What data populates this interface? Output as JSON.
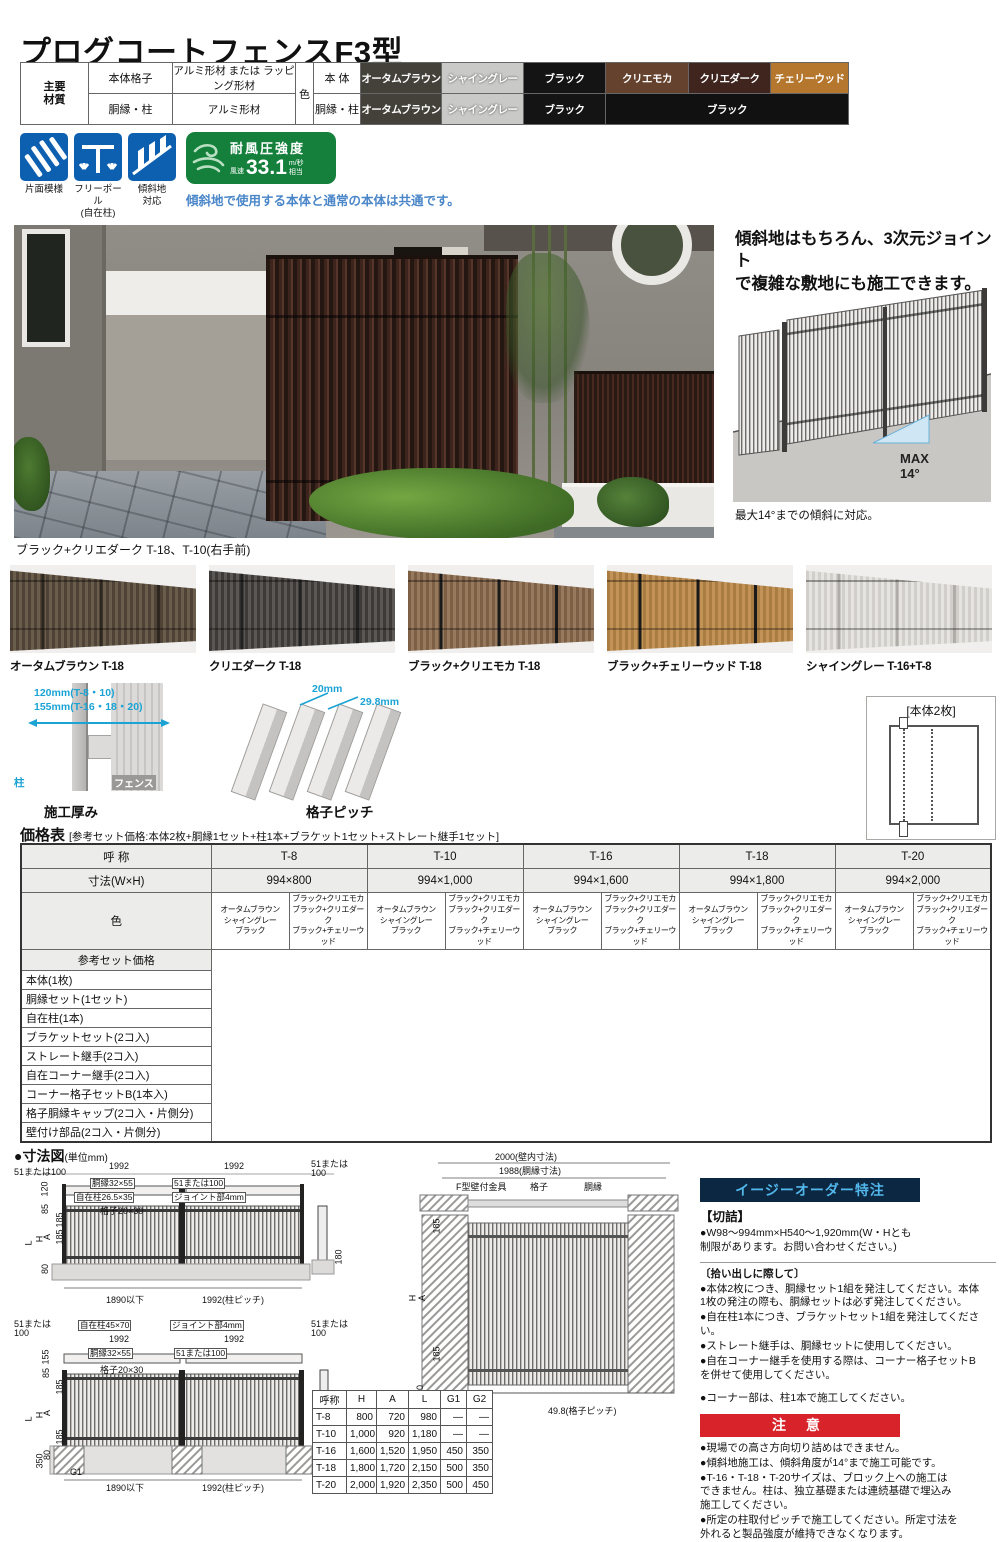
{
  "title": "プログコートフェンスF3型",
  "materials": {
    "header": "主要\n材質",
    "rows": [
      {
        "part": "本体格子",
        "value": "アルミ形材 または ラッピング形材"
      },
      {
        "part": "胴縁・柱",
        "value": "アルミ形材"
      }
    ],
    "color_label": "色",
    "body_row_label": "本 体",
    "frame_row_label": "胴縁・柱",
    "body_chips": [
      {
        "label": "オータムブラウン",
        "bg": "#44403a",
        "fg": "#ffffff"
      },
      {
        "label": "シャイングレー",
        "bg": "#c9c9c7",
        "fg": "#ffffff",
        "c": "sh"
      },
      {
        "label": "ブラック",
        "bg": "#141414",
        "fg": "#ffffff"
      },
      {
        "label": "クリエモカ",
        "bg": "#64422e",
        "fg": "#ffffff"
      },
      {
        "label": "クリエダーク",
        "bg": "#40251f",
        "fg": "#ffffff"
      },
      {
        "label": "チェリーウッド",
        "bg": "#b5772e",
        "fg": "#ffffff"
      }
    ],
    "frame_chips": [
      {
        "label": "オータムブラウン",
        "bg": "#44403a",
        "fg": "#ffffff",
        "span": 1
      },
      {
        "label": "シャイングレー",
        "bg": "#c9c9c7",
        "fg": "#ffffff",
        "span": 1,
        "c": "sh"
      },
      {
        "label": "ブラック",
        "bg": "#141414",
        "fg": "#ffffff",
        "span": 1
      },
      {
        "label": "ブラック",
        "bg": "#111111",
        "fg": "#ffffff",
        "span": 3
      }
    ]
  },
  "features": {
    "icons": [
      {
        "label": "片面模様"
      },
      {
        "label": "フリーポール\n(自在柱)"
      },
      {
        "label": "傾斜地\n対応"
      }
    ],
    "wind": {
      "title": "耐風圧強度",
      "speed_label": "風速",
      "value": "33.1",
      "unit": "m/秒",
      "suffix": "相当"
    },
    "note": "傾斜地で使用する本体と通常の本体は共通です。",
    "icon_color": "#0d5fb0",
    "badge_color": "#14803c"
  },
  "photo": {
    "caption": "ブラック+クリエダーク T-18、T-10(右手前)"
  },
  "slope": {
    "heading": "傾斜地はもちろん、3次元ジョイント\nで複雑な敷地にも施工できます。",
    "max_label": "MAX\n14°",
    "caption": "最大14°までの傾斜に対応。"
  },
  "variations": [
    {
      "label": "オータムブラウン T-18",
      "slat": "#4e4336",
      "lite": "#6b5d4b",
      "post": "#2e271f"
    },
    {
      "label": "クリエダーク T-18",
      "slat": "#3e3a38",
      "lite": "#5b5754",
      "post": "#222222"
    },
    {
      "label": "ブラック+クリエモカ T-18",
      "slat": "#7c5f45",
      "lite": "#97795e",
      "post": "#1a1a1a"
    },
    {
      "label": "ブラック+チェリーウッド T-18",
      "slat": "#a97c42",
      "lite": "#c29257",
      "post": "#1a1a1a"
    },
    {
      "label": "シャイングレー T-16+T-8",
      "slat": "#d2cfca",
      "lite": "#e6e4e0",
      "post": "#b0ada8"
    }
  ],
  "spec": {
    "thickness": {
      "dim1": "120mm(T-8・10)",
      "dim2": "155mm(T-16・18・20)",
      "post_label": "柱",
      "fence_label": "フェンス",
      "caption": "施工厚み"
    },
    "pitch": {
      "dim1": "20mm",
      "dim2": "29.8mm",
      "caption": "格子ピッチ"
    },
    "panel_note": "[本体2枚]"
  },
  "price": {
    "title": "価格表",
    "subtitle": "[参考セット価格:本体2枚+胴縁1セット+柱1本+ブラケット1セット+ストレート継手1セット]",
    "name_header": "呼 称",
    "size_header": "寸法(W×H)",
    "color_header": "色",
    "set_header": "参考セット価格",
    "columns": [
      {
        "name": "T-8",
        "size": "994×800",
        "colors_a": "オータムブラウン\nシャイングレー\nブラック",
        "colors_b": "ブラック+クリエモカ\nブラック+クリエダーク\nブラック+チェリーウッド"
      },
      {
        "name": "T-10",
        "size": "994×1,000",
        "colors_a": "オータムブラウン\nシャイングレー\nブラック",
        "colors_b": "ブラック+クリエモカ\nブラック+クリエダーク\nブラック+チェリーウッド"
      },
      {
        "name": "T-16",
        "size": "994×1,600",
        "colors_a": "オータムブラウン\nシャイングレー\nブラック",
        "colors_b": "ブラック+クリエモカ\nブラック+クリエダーク\nブラック+チェリーウッド"
      },
      {
        "name": "T-18",
        "size": "994×1,800",
        "colors_a": "オータムブラウン\nシャイングレー\nブラック",
        "colors_b": "ブラック+クリエモカ\nブラック+クリエダーク\nブラック+チェリーウッド"
      },
      {
        "name": "T-20",
        "size": "994×2,000",
        "colors_a": "オータムブラウン\nシャイングレー\nブラック",
        "colors_b": "ブラック+クリエモカ\nブラック+クリエダーク\nブラック+チェリーウッド"
      }
    ],
    "items": [
      "本体(1枚)",
      "胴縁セット(1セット)",
      "自在柱(1本)",
      "ブラケットセット(2コ入)",
      "ストレート継手(2コ入)",
      "自在コーナー継手(2コ入)",
      "コーナー格子セットB(1本入)",
      "格子胴縁キャップ(2コ入・片側分)",
      "壁付け部品(2コ入・片側分)"
    ]
  },
  "dims": {
    "section_title": "●寸法図",
    "unit": "(単位mm)",
    "diagram_a_labels": [
      {
        "t": "51または100",
        "x": 0,
        "y": 8
      },
      {
        "t": "1992",
        "x": 95,
        "y": 2
      },
      {
        "t": "1992",
        "x": 210,
        "y": 2
      },
      {
        "t": "51または",
        "x": 297,
        "y": 0
      },
      {
        "t": "100",
        "x": 297,
        "y": 9
      },
      {
        "t": "胴縁32×55",
        "x": 76,
        "y": 18,
        "c": "bx"
      },
      {
        "t": "51または100",
        "x": 158,
        "y": 18,
        "c": "bx"
      },
      {
        "t": "自在柱26.5×35",
        "x": 60,
        "y": 32,
        "c": "bx"
      },
      {
        "t": "ジョイント部4mm",
        "x": 158,
        "y": 32,
        "c": "bx"
      },
      {
        "t": "格子20×30",
        "x": 86,
        "y": 47
      },
      {
        "t": "120",
        "x": 24,
        "y": 24,
        "c": "v"
      },
      {
        "t": "85",
        "x": 27,
        "y": 44,
        "c": "v"
      },
      {
        "t": "185",
        "x": 39,
        "y": 55,
        "c": "v"
      },
      {
        "t": "185",
        "x": 39,
        "y": 72,
        "c": "v"
      },
      {
        "t": "A",
        "x": 31,
        "y": 72,
        "c": "v"
      },
      {
        "t": "H",
        "x": 23,
        "y": 74,
        "c": "v"
      },
      {
        "t": "L",
        "x": 13,
        "y": 78,
        "c": "v"
      },
      {
        "t": "80",
        "x": 27,
        "y": 104,
        "c": "v"
      },
      {
        "t": "1890以下",
        "x": 92,
        "y": 136
      },
      {
        "t": "1992(柱ピッチ)",
        "x": 188,
        "y": 136
      },
      {
        "t": "180",
        "x": 318,
        "y": 92,
        "c": "v"
      }
    ],
    "diagram_b_labels": [
      {
        "t": "51または",
        "x": 0,
        "y": 0
      },
      {
        "t": "100",
        "x": 0,
        "y": 9
      },
      {
        "t": "自在柱45×70",
        "x": 64,
        "y": 0,
        "c": "bx"
      },
      {
        "t": "ジョイント部4mm",
        "x": 156,
        "y": 0,
        "c": "bx"
      },
      {
        "t": "1992",
        "x": 95,
        "y": 15
      },
      {
        "t": "1992",
        "x": 210,
        "y": 15
      },
      {
        "t": "51または",
        "x": 297,
        "y": 0
      },
      {
        "t": "100",
        "x": 297,
        "y": 9
      },
      {
        "t": "胴縁32×55",
        "x": 74,
        "y": 28,
        "c": "bx"
      },
      {
        "t": "51または100",
        "x": 160,
        "y": 28,
        "c": "bx"
      },
      {
        "t": "格子20×30",
        "x": 86,
        "y": 46
      },
      {
        "t": "155",
        "x": 25,
        "y": 32,
        "c": "v"
      },
      {
        "t": "85",
        "x": 28,
        "y": 48,
        "c": "v"
      },
      {
        "t": "185",
        "x": 39,
        "y": 62,
        "c": "v"
      },
      {
        "t": "A",
        "x": 31,
        "y": 88,
        "c": "v"
      },
      {
        "t": "H",
        "x": 23,
        "y": 90,
        "c": "v"
      },
      {
        "t": "L",
        "x": 13,
        "y": 94,
        "c": "v"
      },
      {
        "t": "185",
        "x": 39,
        "y": 112,
        "c": "v"
      },
      {
        "t": "350",
        "x": 19,
        "y": 136,
        "c": "v"
      },
      {
        "t": "80",
        "x": 29,
        "y": 130,
        "c": "v"
      },
      {
        "t": "G1",
        "x": 56,
        "y": 148
      },
      {
        "t": "1890以下",
        "x": 92,
        "y": 164
      },
      {
        "t": "1992(柱ピッチ)",
        "x": 188,
        "y": 164
      },
      {
        "t": "G1",
        "x": 302,
        "y": 164
      },
      {
        "t": "G2",
        "x": 324,
        "y": 136,
        "c": "v"
      }
    ],
    "diagram_c_labels": [
      {
        "t": "2000(壁内寸法)",
        "x": 95,
        "y": 0
      },
      {
        "t": "1988(胴縁寸法)",
        "x": 99,
        "y": 14
      },
      {
        "t": "F型壁付金具",
        "x": 56,
        "y": 30
      },
      {
        "t": "格子",
        "x": 130,
        "y": 30
      },
      {
        "t": "胴縁",
        "x": 184,
        "y": 30
      },
      {
        "t": "185",
        "x": 30,
        "y": 68,
        "c": "v"
      },
      {
        "t": "H",
        "x": 10,
        "y": 140,
        "c": "v"
      },
      {
        "t": "A",
        "x": 20,
        "y": 140,
        "c": "v"
      },
      {
        "t": "185",
        "x": 30,
        "y": 196,
        "c": "v"
      },
      {
        "t": "80",
        "x": 16,
        "y": 232,
        "c": "v"
      },
      {
        "t": "49.8(格子ピッチ)",
        "x": 148,
        "y": 254
      }
    ],
    "table": {
      "headers": [
        "呼称",
        "H",
        "A",
        "L",
        "G1",
        "G2"
      ],
      "rows": [
        {
          "c0": "T-8",
          "c1": "800",
          "c2": "720",
          "c3": "980",
          "c4": "―",
          "c5": "―"
        },
        {
          "c0": "T-10",
          "c1": "1,000",
          "c2": "920",
          "c3": "1,180",
          "c4": "―",
          "c5": "―"
        },
        {
          "c0": "T-16",
          "c1": "1,600",
          "c2": "1,520",
          "c3": "1,950",
          "c4": "450",
          "c5": "350"
        },
        {
          "c0": "T-18",
          "c1": "1,800",
          "c2": "1,720",
          "c3": "2,150",
          "c4": "500",
          "c5": "350"
        },
        {
          "c0": "T-20",
          "c1": "2,000",
          "c2": "1,920",
          "c3": "2,350",
          "c4": "500",
          "c5": "450"
        }
      ]
    }
  },
  "easy_order": {
    "header": "イージーオーダー特注",
    "header_bg": "#0c2742",
    "header_fg": "#52b7ea",
    "cut_title": "【切詰】",
    "cut_body": "●W98〜994mm×H540〜1,920mm(W・Hとも\n制限があります。お問い合わせください。)",
    "pick_title": "〔拾い出しに際して〕",
    "pick_items": [
      "●本体2枚につき、胴縁セット1組を発注してください。本体\n1枚の発注の際も、胴縁セットは必ず発注してください。",
      "●自在柱1本につき、ブラケットセット1組を発注してください。",
      "●ストレート継手は、胴縁セットに使用してください。",
      "●自在コーナー継手を使用する際は、コーナー格子セットB\nを併せて使用してください。"
    ],
    "corner_note": "●コーナー部は、柱1本で施工してください。"
  },
  "caution": {
    "header": "注 意",
    "header_bg": "#d9232a",
    "items": [
      "●現場での高さ方向切り詰めはできません。",
      "●傾斜地施工は、傾斜角度が14°まで施工可能です。",
      "●T-16・T-18・T-20サイズは、ブロック上への施工は\nできません。柱は、独立基礎または連続基礎で埋込み\n施工してください。",
      "●所定の柱取付ピッチで施工してください。所定寸法を\n外れると製品強度が維持できなくなります。"
    ]
  }
}
